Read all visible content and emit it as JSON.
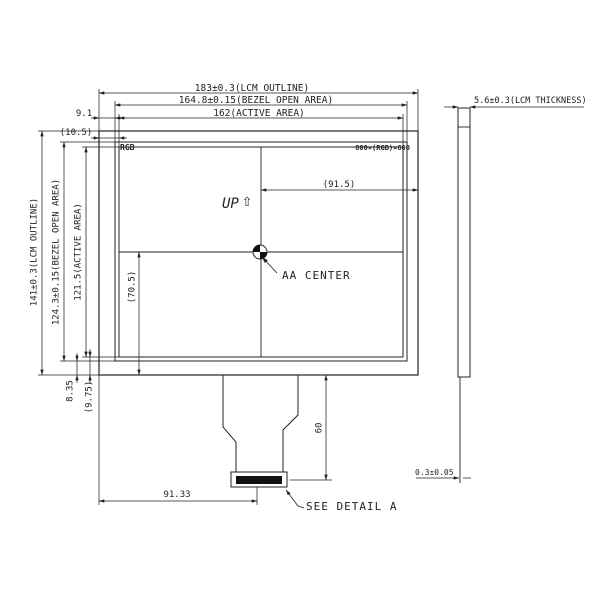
{
  "colors": {
    "ink": "#222222",
    "background": "#ffffff",
    "connector_fill": "#111111"
  },
  "front_view": {
    "panel_text": {
      "rgb": "RGB",
      "resolution": "800×(RGB)×600",
      "up": "UP",
      "up_arrow": "⇧"
    },
    "annotations": {
      "aa_center": "AA CENTER",
      "see_detail": "SEE DETAIL A"
    },
    "dims": {
      "outline_width": "183±0.3(LCM OUTLINE)",
      "bezel_width": "164.8±0.15(BEZEL OPEN AREA)",
      "active_width": "162(ACTIVE AREA)",
      "left_offset_bezel": "9.1",
      "left_offset_active": "(10.5)",
      "outline_height": "141±0.3(LCM OUTLINE)",
      "bezel_height": "124.3±0.15(BEZEL OPEN AREA)",
      "active_height": "121.5(ACTIVE AREA)",
      "center_to_right": "(91.5)",
      "center_to_bottom": "(70.5)",
      "bottom_offset_bezel": "8.35",
      "bottom_offset_active": "(9.75)",
      "fpc_length": "60",
      "connector_center_x": "91.33"
    }
  },
  "side_view": {
    "dims": {
      "thickness": "5.6±0.3(LCM THICKNESS)",
      "fpc_thickness": "0.3±0.05"
    }
  }
}
